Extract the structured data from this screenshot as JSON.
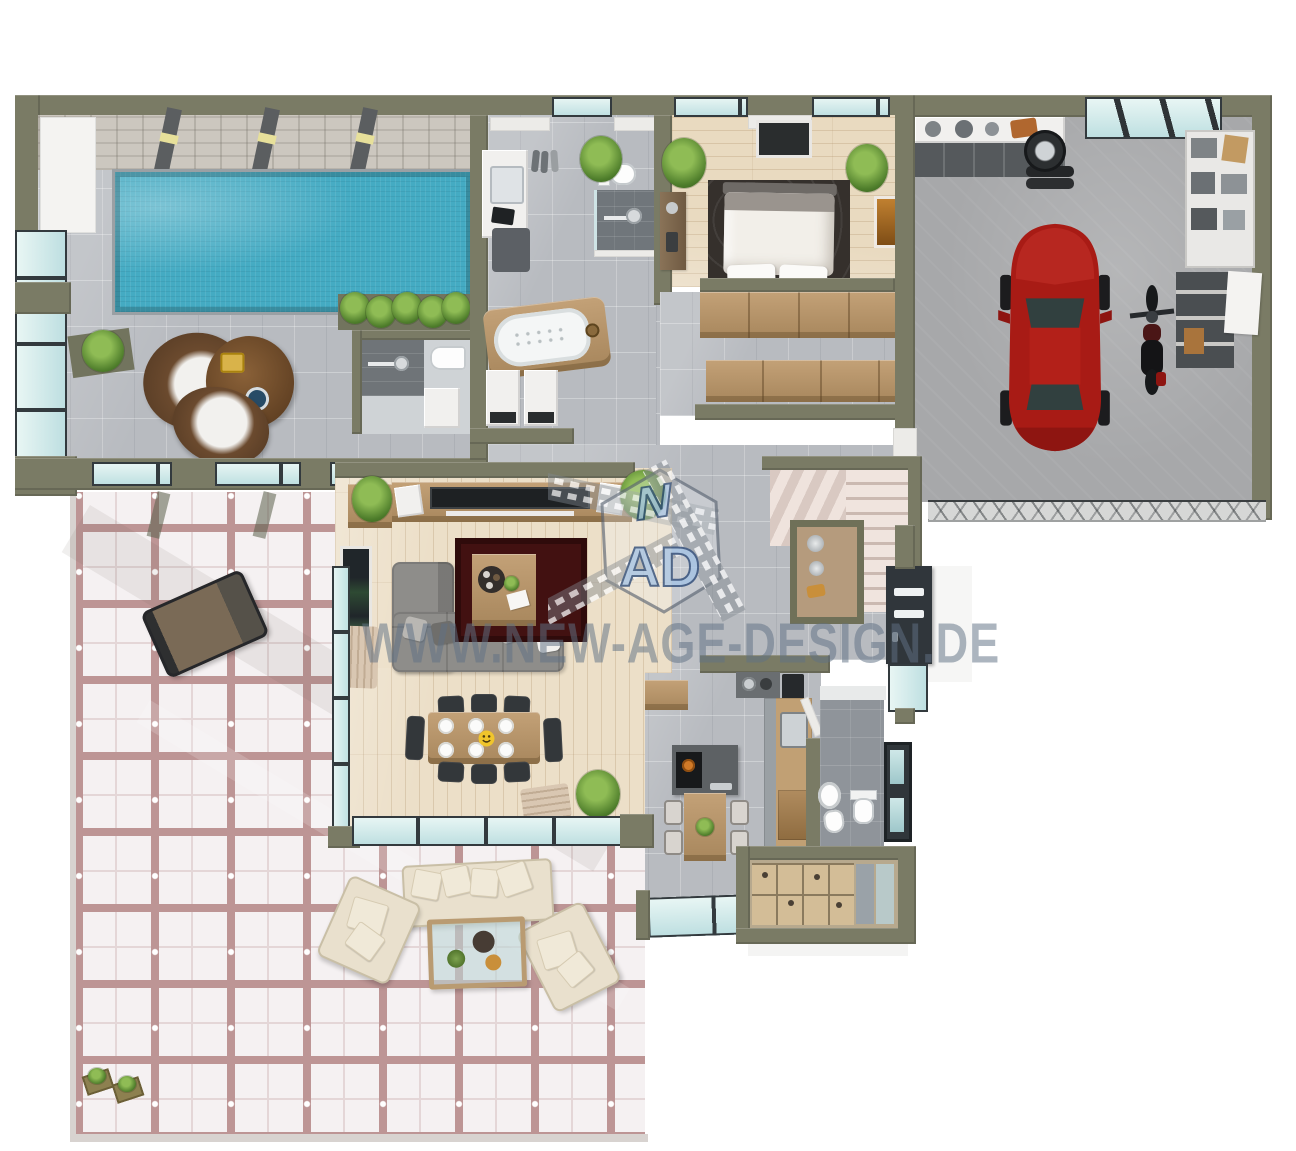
{
  "scene": {
    "type": "3d-floor-plan-render",
    "view": "top-down",
    "background": "#ffffff",
    "source_branding_visible": true
  },
  "watermark": {
    "text": "WWW.NEW-AGE-DESIGN.DE",
    "color": "#607184",
    "opacity": 0.52
  },
  "logo": {
    "top_letter": "N",
    "bottom_letters": "AD",
    "fill": "#a9c7e8",
    "outline": "#2f4d7b",
    "decoration": "film-strip-ribbon-around-hexagon"
  },
  "palette": {
    "wall": "#7a7b65",
    "wall_inner": "#ecebe8",
    "tile_gray": "#b8bbc0",
    "wood_floor": "#ecdfc8",
    "pool_water": "#44abc3",
    "terrace_tile": "#f5f1f2",
    "terrace_grout": "#bd9595",
    "garage_floor": "#a7a8aa",
    "car_red": "#a81b15",
    "sofa_gray": "#8e8d8a",
    "rug_dark_red": "#421111",
    "furniture_wood": "#c3a177",
    "outdoor_cream": "#e9e0cd",
    "glass": "#bcdee0",
    "frame_dark": "#333a3e",
    "plant_green": "#4e7d2b",
    "stone_wall": "#ccc7bf"
  },
  "rooms": {
    "pool_area": {
      "label": "indoor pool area",
      "furniture": [
        "swimming-pool",
        "stone-feature-wall",
        "ceiling-beams",
        "sun-lounger",
        "sun-lounger",
        "side-table-with-tray",
        "potted-plant",
        "planter-hedge",
        "pool-shower",
        "toilet",
        "glass-facade"
      ]
    },
    "bathroom": {
      "label": "bathroom / utility",
      "furniture": [
        "vanity-sink",
        "shoes",
        "toilet",
        "walk-in-shower",
        "bath-mat",
        "corner-bathtub",
        "washing-machine",
        "dryer",
        "potted-plant",
        "entry-glass-door"
      ]
    },
    "bedroom": {
      "label": "bedroom",
      "furniture": [
        "double-bed",
        "dark-area-rug",
        "wall-tv",
        "dresser",
        "potted-plant",
        "potted-plant",
        "wall-picture",
        "window-band"
      ]
    },
    "dressing_room": {
      "label": "walk-in closet",
      "furniture": [
        "wardrobe-row",
        "wardrobe-row"
      ]
    },
    "garage": {
      "label": "garage",
      "furniture": [
        "red-car",
        "motorcycle",
        "workbench",
        "tool-wall",
        "tire-rack",
        "wall-shelves",
        "white-board",
        "garage-door",
        "skylights",
        "service-door"
      ]
    },
    "hallway": {
      "label": "hallway",
      "furniture": [
        "l-shaped-staircase",
        "display-niche",
        "front-door",
        "door-sidelight"
      ]
    },
    "living_room": {
      "label": "living / dining room",
      "furniture": [
        "tv-sideboard",
        "flat-tv",
        "speaker",
        "speaker",
        "corner-cabinet",
        "l-shaped-sofa",
        "throw-pillows",
        "dark-red-rug",
        "coffee-table-with-tray",
        "dining-table",
        "dining-chairs-6",
        "end-benches-2",
        "white-plates-6",
        "smiley-plate",
        "curtain",
        "curtain",
        "art-panel",
        "potted-plant",
        "potted-plant",
        "potted-plant",
        "window-front"
      ]
    },
    "kitchen": {
      "label": "kitchen",
      "furniture": [
        "kitchen-island-with-cooktop",
        "breakfast-table",
        "bar-stools-4",
        "wall-counter",
        "sink",
        "corner-cooktop",
        "coffee-machine",
        "sideboard",
        "potted-plant",
        "window-band"
      ]
    },
    "guest_wc": {
      "label": "guest WC",
      "furniture": [
        "washbasin",
        "bidet",
        "toilet",
        "window"
      ]
    },
    "storage_room": {
      "label": "storage room",
      "furniture": [
        "open-compartment-unit",
        "gray-panels",
        "white-step"
      ]
    },
    "terrace": {
      "label": "terrace",
      "furniture": [
        "sun-lounger",
        "sun-lounger",
        "round-side-table",
        "outdoor-sofa",
        "outdoor-armchair",
        "outdoor-armchair",
        "glass-coffee-table",
        "planter-box",
        "planter-box",
        "pergola-shadow-beams"
      ]
    }
  }
}
